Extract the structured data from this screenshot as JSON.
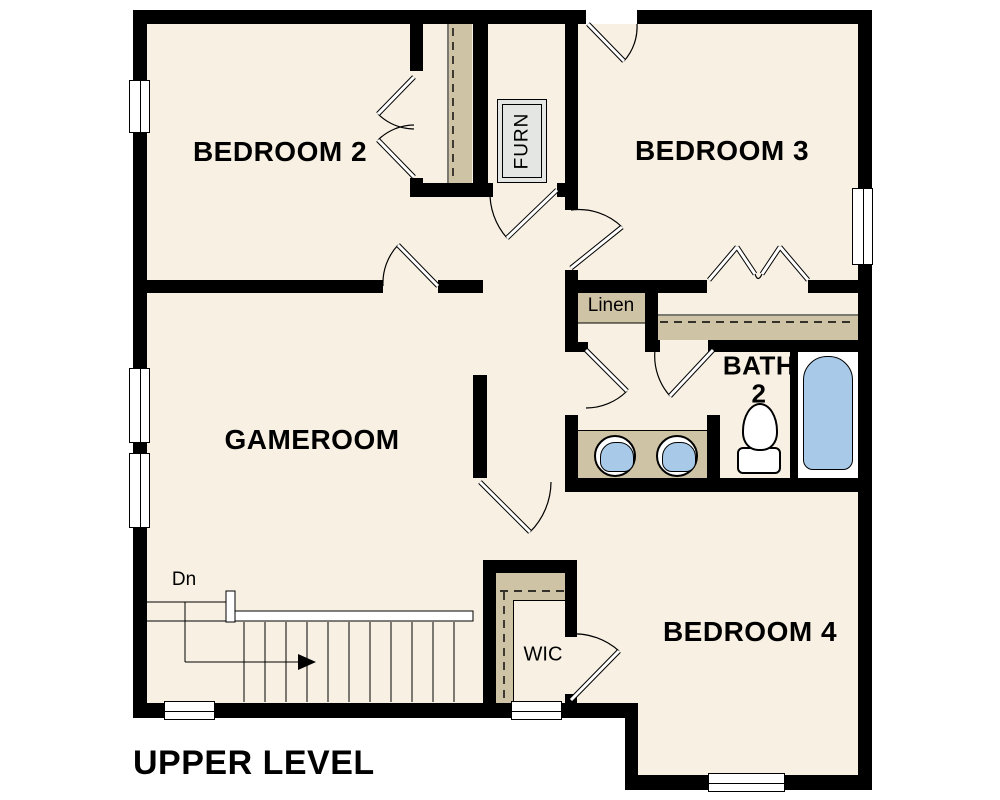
{
  "plan": {
    "title": "UPPER LEVEL",
    "rooms": {
      "bedroom2": "BEDROOM 2",
      "bedroom3": "BEDROOM 3",
      "gameroom": "GAMEROOM",
      "bedroom4": "BEDROOM 4",
      "bath_line1": "BATH",
      "bath_line2": "2",
      "linen": "Linen",
      "wic": "WIC",
      "furnace": "FURN"
    },
    "stairs": {
      "direction_label": "Dn",
      "tread_count": 11
    }
  },
  "colors": {
    "background": "#ffffff",
    "floor": "#f7f0e3",
    "wall": "#000000",
    "closet-shelf": "#cfc3a6",
    "fixture-blue": "#a8c9e8",
    "furnace-gray": "#e4e6e3"
  }
}
